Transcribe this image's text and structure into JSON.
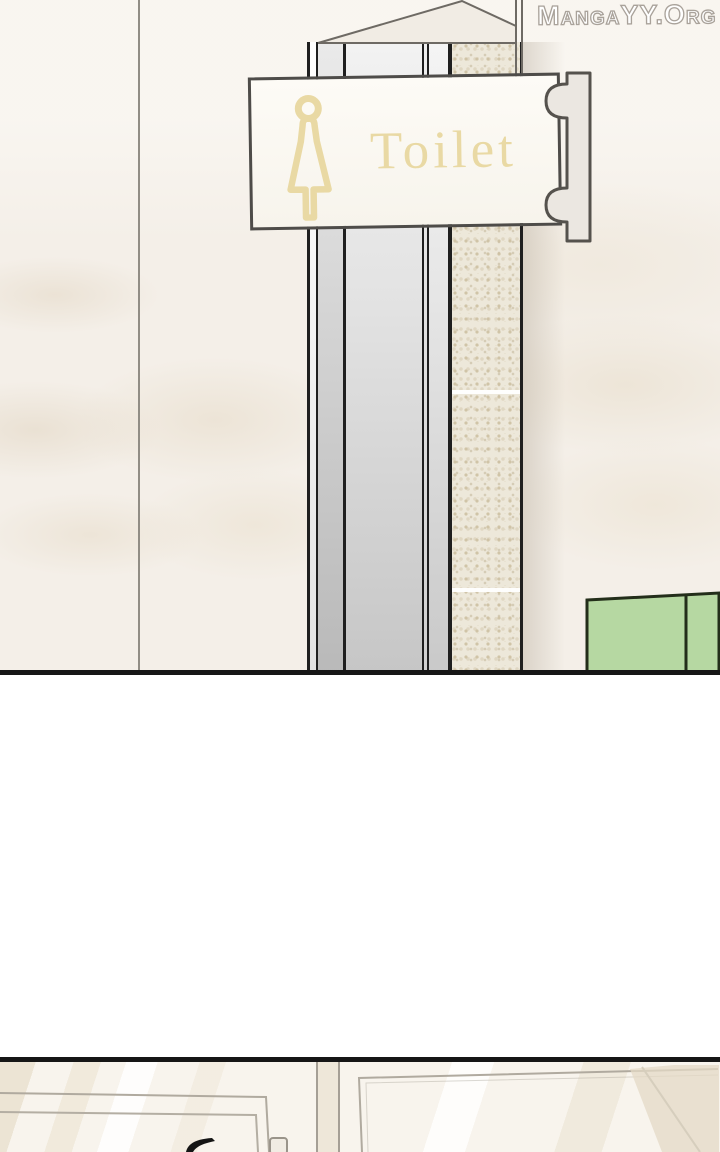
{
  "watermark": {
    "text": "MangaYY.Org",
    "fill": "#ffffff",
    "outline": "#a9a29a"
  },
  "panel1": {
    "id": "toilet-entrance-panel",
    "sign": {
      "label": "Toilet",
      "icon": "female-figure-icon",
      "text_color": "#e9d9a4",
      "background": "#fdfbf6",
      "border_color": "#4e4c49"
    },
    "colors": {
      "wall": "#f4efe8",
      "pillar_gray": "#c6c6c6",
      "tile_column": "#ede8da",
      "cabinet_green": "#b6d8a2",
      "line_dark": "#1f1f1f"
    }
  },
  "panel2": {
    "id": "mirror-closeup-panel",
    "colors": {
      "glass": "#f8f4ed",
      "frame_line": "#b0aa9f",
      "hair_silhouette": "#151515"
    }
  },
  "layout": {
    "panel_border_color": "#161616"
  }
}
